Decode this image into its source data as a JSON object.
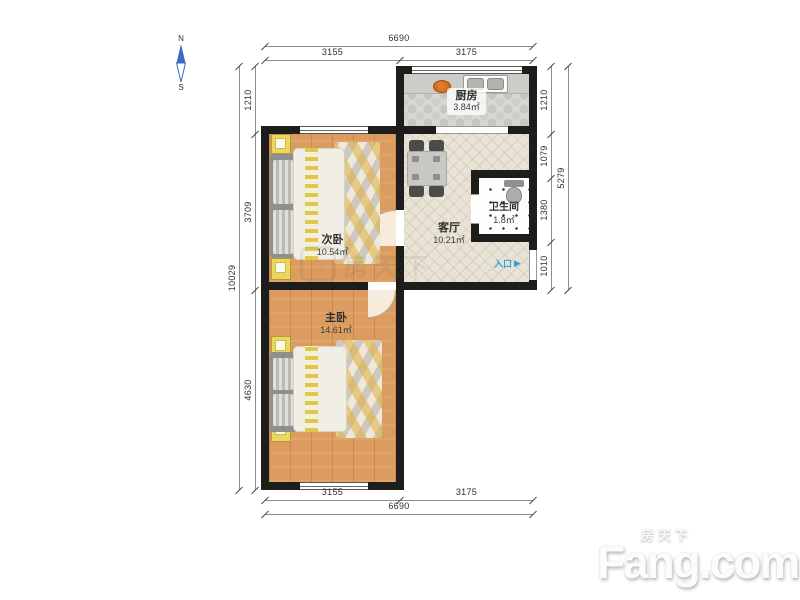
{
  "compass": {
    "north": "N",
    "south": "S"
  },
  "rooms": {
    "kitchen": {
      "name": "厨房",
      "area": "3.84㎡"
    },
    "second_bedroom": {
      "name": "次卧",
      "area": "10.54㎡"
    },
    "living": {
      "name": "客厅",
      "area": "10.21㎡"
    },
    "bathroom": {
      "name": "卫生间",
      "area": "1.8㎡"
    },
    "master_bedroom": {
      "name": "主卧",
      "area": "14.61㎡"
    }
  },
  "entrance": {
    "label": "入口",
    "arrow": "▶"
  },
  "dimensions": {
    "top": {
      "total": "6690",
      "seg_left": "3155",
      "seg_right": "3175"
    },
    "bottom": {
      "total": "6690",
      "seg_left": "3155",
      "seg_right": "3175"
    },
    "left": {
      "total": "10029",
      "seg_1": "1210",
      "seg_2": "3709",
      "seg_3": "4630"
    },
    "right": {
      "total": "5279",
      "seg_1": "1210",
      "seg_2": "1079",
      "seg_3": "1380",
      "seg_4": "1010"
    }
  },
  "watermark": {
    "brand_cn": "房天下",
    "brand_en": "Fang.com",
    "house_glyph": "⌂"
  },
  "colors": {
    "wall": "#1d1d1b",
    "wood_floor": "#dc9b5f",
    "entrance_blue": "#2f9fe0",
    "compass_blue": "#3a6cc0"
  }
}
